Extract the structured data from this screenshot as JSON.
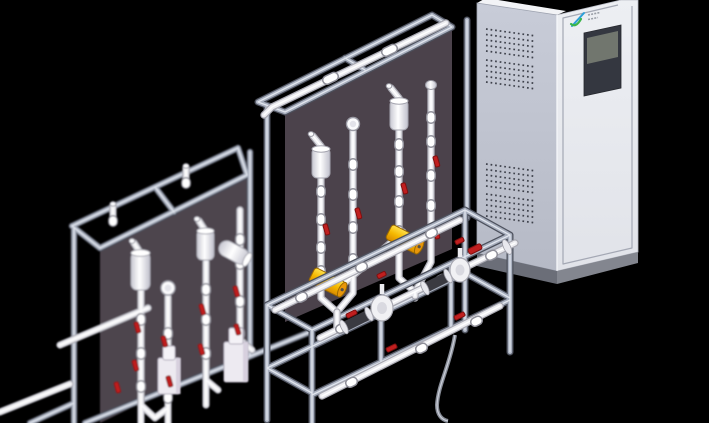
{
  "scene": {
    "description": "Isometric 3D CAD rendering on a black background: two aluminium-framed chemical dosing skids with dark back panels, white piping, red valve handles, pulsation dampeners, pressure gauges, yellow calibration cylinders and dosing pumps, next to a tall light-grey control cabinet with ventilation grilles, a brand logo and a blank HMI screen",
    "background": "#000000",
    "objects": [
      "left dosing skid",
      "main dosing skid",
      "control cabinet"
    ]
  },
  "palette": {
    "bg": "#000000",
    "panel": "#4b424b",
    "panelLeft": "#4e454e",
    "frameDark": "#4d515d",
    "frameMid": "#a9b0bf",
    "frameLight": "#e2e6ee",
    "pipeShadow": "#a7a7b0",
    "pipeBody": "#ececf0",
    "pipeLight": "#ffffff",
    "fittingStroke": "#8f8f99",
    "red": "#c01f1f",
    "redDark": "#7e1010",
    "yellow": "#ffcc05",
    "yellowShade": "#e8960a",
    "yellowDark": "#9c6a00",
    "pumpLav": "#d7d0de",
    "dark": "#3a3a41",
    "cabSide": "#c2c6d2",
    "cabFront": "#eaebf0",
    "cabTop": "#f2f3f6",
    "cabPlinth": "#83868f",
    "cabPlinthSide": "#6b6e78",
    "vent": "#3e414b",
    "bezel": "#343740",
    "screenFace": "#71766e",
    "logoGreen": "#3bb54a",
    "logoBlue": "#2b9fd8",
    "lineGray": "#a4a8b4",
    "hose": "#888d98"
  },
  "cabinet": {
    "vent_bands": 4,
    "vent_rows_per_band": 5,
    "screen_state": "blank",
    "logo": {
      "green": "#3bb54a",
      "blue": "#2b9fd8",
      "wordmark_legible": false
    }
  },
  "equipment": {
    "skids": [
      {
        "id": "left",
        "back_panel_color": "#4e454e",
        "pumps": 2,
        "pulsation_dampeners": 3,
        "pressure_gauges": 1,
        "red_valve_handles": 9
      },
      {
        "id": "main",
        "back_panel_color": "#4b424b",
        "pumps": 2,
        "pulsation_dampeners": 2,
        "pressure_gauges": 2,
        "calibration_cylinders_yellow": 2,
        "red_valve_handles": 11
      }
    ]
  }
}
